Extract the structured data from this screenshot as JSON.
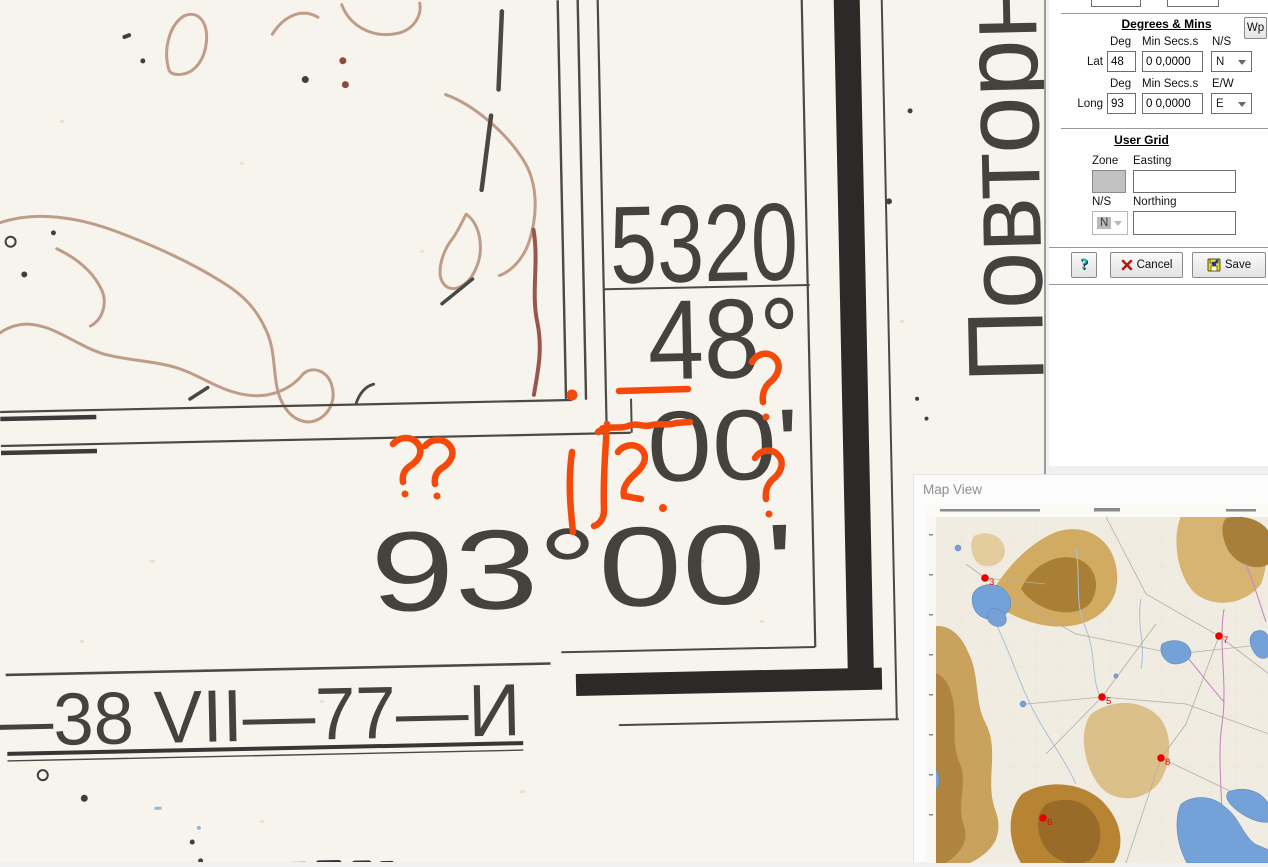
{
  "map_scan": {
    "grid_number": "5320",
    "latitude_degrees": "48°",
    "latitude_minutes": "00'",
    "longitude_label": "93°00'",
    "sheet_designation": "—38 VII—77—И",
    "side_vertical_text": "Повторн",
    "annotation_color": "#f4490a"
  },
  "dialog": {
    "degrees_mins": {
      "title": "Degrees & Mins",
      "wp_button": "Wp",
      "lat": {
        "label": "Lat",
        "deg_header": "Deg",
        "min_header": "Min Secs.s",
        "hemi_header": "N/S",
        "deg_value": "48",
        "min_value": "0 0,0000",
        "hemi_value": "N"
      },
      "long": {
        "label": "Long",
        "deg_header": "Deg",
        "min_header": "Min Secs.s",
        "hemi_header": "E/W",
        "deg_value": "93",
        "min_value": "0 0,0000",
        "hemi_value": "E"
      }
    },
    "user_grid": {
      "title": "User Grid",
      "zone_label": "Zone",
      "easting_label": "Easting",
      "ns_label": "N/S",
      "northing_label": "Northing",
      "zone_value": "",
      "easting_value": "",
      "ns_value": "N",
      "northing_value": ""
    },
    "buttons": {
      "help": "?",
      "cancel": "Cancel",
      "save": "Save"
    }
  },
  "map_view": {
    "title": "Map View",
    "waypoint_color": "#e60000",
    "waypoints": [
      {
        "label": "3",
        "x": 59,
        "y": 74
      },
      {
        "label": "7",
        "x": 293,
        "y": 132
      },
      {
        "label": "5",
        "x": 176,
        "y": 193
      },
      {
        "label": "8",
        "x": 235,
        "y": 254
      },
      {
        "label": "6",
        "x": 117,
        "y": 314
      }
    ]
  }
}
